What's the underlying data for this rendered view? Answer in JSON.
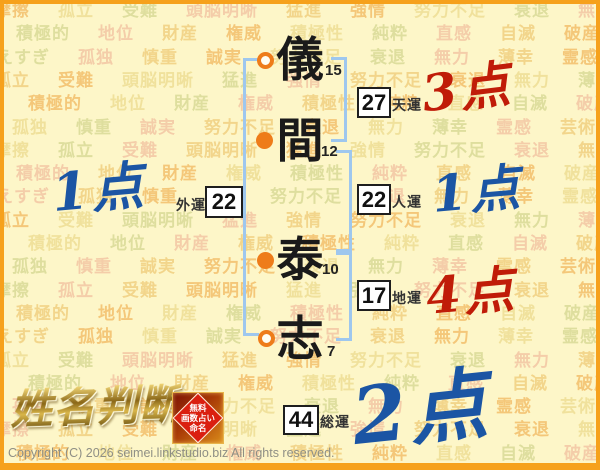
{
  "watermark": {
    "patterns": [
      [
        "摩擦",
        "孤立",
        "受難",
        "頭脳明晰",
        "猛進",
        "強情",
        "努力不足",
        "衰退",
        "無力",
        "薄幸",
        "霊感",
        "遅咲き",
        "摩擦",
        "孤立",
        "受難"
      ],
      [
        "芸術",
        "積極的",
        "地位",
        "財産",
        "権威",
        "積極性",
        "純粋",
        "直感",
        "自滅",
        "破産",
        "病気",
        "遅咲き",
        "芸術",
        "積極的",
        "地位",
        "財産"
      ],
      [
        "考えすぎ",
        "孤独",
        "慎重",
        "誠実",
        "努力不足",
        "衰退",
        "無力",
        "薄幸",
        "霊感",
        "芸術",
        "摩擦",
        "孤立",
        "考えすぎ",
        "孤独",
        "慎重"
      ]
    ],
    "row_count": 20,
    "row_height": 23.3,
    "offsets": [
      -6,
      -48,
      -22,
      -70,
      -36,
      -88
    ],
    "colors": [
      "#f2bc66",
      "#eedd92",
      "#d7d994",
      "#f2c4a2",
      "#f0cd7c"
    ]
  },
  "name_chart": {
    "characters": [
      {
        "glyph": "儀",
        "strokes": "15",
        "marker": "open"
      },
      {
        "glyph": "間",
        "strokes": "12",
        "marker": "filled"
      },
      {
        "glyph": "泰",
        "strokes": "10",
        "marker": "filled"
      },
      {
        "glyph": "志",
        "strokes": "7",
        "marker": "open"
      }
    ],
    "values": {
      "tenun": {
        "label": "天運",
        "value": "27",
        "score": "3点",
        "score_color": "red"
      },
      "jinun": {
        "label": "人運",
        "value": "22",
        "score": "1点",
        "score_color": "blue"
      },
      "chiun": {
        "label": "地運",
        "value": "17",
        "score": "4点",
        "score_color": "red"
      },
      "gaiun": {
        "label": "外運",
        "value": "22",
        "score": "1点",
        "score_color": "blue"
      },
      "souun": {
        "label": "総運",
        "value": "44",
        "score": "2点",
        "score_color": "blue"
      }
    }
  },
  "branding": {
    "logo_text": "姓名判断",
    "seal_lines": [
      "無料",
      "画数占い",
      "命名"
    ]
  },
  "footer": {
    "copyright": "Copyright (C) 2026 seimei.linkstudio.biz All rights reserved."
  },
  "colors": {
    "background": "#fdf6c8",
    "frame_orange": "#f6a11c",
    "bracket_blue": "#9ec7ee",
    "marker_orange": "#ee7c1a",
    "score_red": "#c01c08",
    "score_blue": "#1b55a4",
    "seal_red": "#da1f0f",
    "logo_gold": "#b8902e"
  }
}
